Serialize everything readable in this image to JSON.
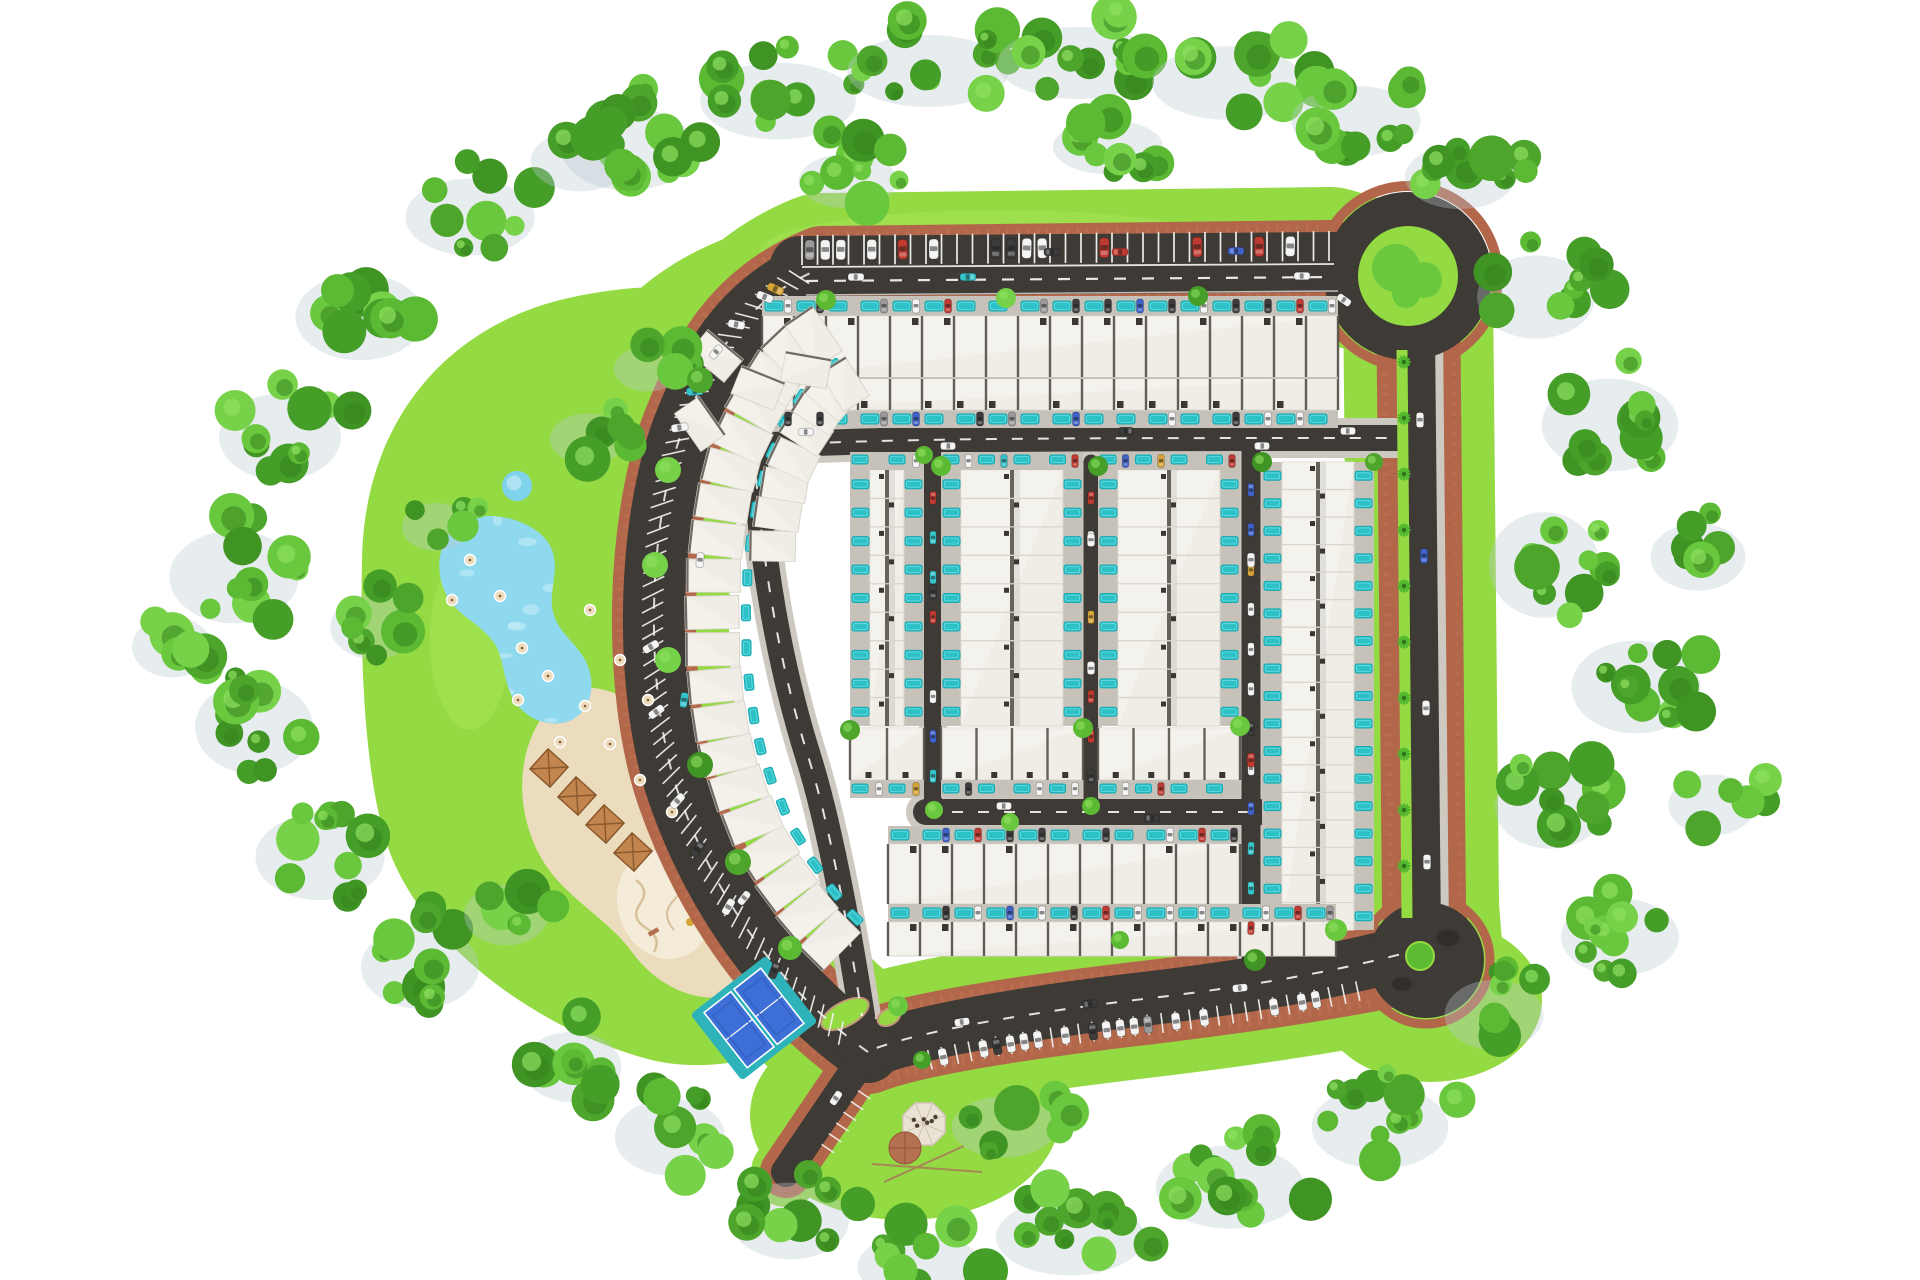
{
  "title": "Residential community master plan - aerial site rendering",
  "canvas": {
    "w": 1920,
    "h": 1280,
    "bg": "#ffffff"
  },
  "approx_counts": {
    "townhouse_units": 300,
    "parking_stalls": 190,
    "cars_visible": 150,
    "roundabouts": 2,
    "sport_courts": 2,
    "lakes": 1,
    "ponds": 1,
    "playgrounds": 1,
    "pergolas": 4,
    "pavilions": 1
  },
  "palette": {
    "lawn": "#94da43",
    "lawnLight": "#a9e55c",
    "asphalt": "#3e3a35",
    "asphaltLight": "#49443e",
    "brick": "#b2674a",
    "brickLight": "#c17a57",
    "brickDark": "#95533a",
    "sidewalk": "#cdc9c1",
    "houseFill": "#f0ede6",
    "houseEdge": "#d9d5cd",
    "houseHi": "#f7f5f0",
    "wallDark": "#4e4943",
    "plotGray": "#c6c2ba",
    "pool": "#2bc1c7",
    "poolDeep": "#17a9b0",
    "poolGlint": "#7fe0e4",
    "lake": "#8fd9ee",
    "lakeLight": "#c9edf8",
    "pond": "#7fd2ec",
    "sand": "#ecdcbe",
    "sandLight": "#f4ebd8",
    "sandLine": "#d6c19b",
    "courtBlue": "#3e6fd6",
    "courtBlueDark": "#2f5cbe",
    "courtApron": "#2fb3ba",
    "pergola": "#c2854d",
    "pergolaDark": "#8a5a2e",
    "pavilionRoof": "#eae2d4",
    "pavilionEdge": "#cfc3ad",
    "dome": "#b5714f",
    "domeDark": "#8f5438",
    "timber": "#a78757",
    "marking": "#f6f6f4",
    "shadow": "#b9c9d2",
    "islandCurb": "#c49a7a",
    "treeGreens": [
      "#4ea52c",
      "#5cb934",
      "#6ac83e",
      "#3f9423",
      "#77d24a",
      "#459e28"
    ],
    "treeDark": "#35821d",
    "treeLight": "#8fdf60",
    "palm": "#4fb52e",
    "palmDark": "#2e6e1a",
    "carColors": {
      "white": "#f2f3f2",
      "red": "#bf3a30",
      "blue": "#3f62c8",
      "teal": "#35c2c8",
      "yellow": "#d7a437",
      "dark": "#3c3c3c",
      "gray": "#9a9a9a"
    }
  },
  "seed": 11,
  "loop": {
    "main": "M 868 1052 C 778 988 714 896 678 792 C 643 690 646 514 688 416 C 714 352 748 298 822 268 L 1330 262 L 1418 288 L 1424 906 L 1428 958 C 1382 968 1302 984 1152 1002 C 1048 1014 918 1032 868 1052 Z",
    "lawnW": 150,
    "brickW": 84
  },
  "lawnShapes": {
    "park": "M 362 560 C 364 426 442 330 560 300 C 636 282 706 282 744 304 C 702 362 664 424 656 520 C 648 620 668 740 706 830 C 744 916 792 976 840 1022 C 786 1058 706 1076 644 1058 C 544 1030 432 954 392 858 C 364 788 360 660 362 560 Z",
    "topBand": "M 600 332 C 660 250 760 212 900 206 L 1340 202 C 1418 206 1466 234 1476 282 C 1482 318 1458 348 1420 356 L 1380 360 C 1300 330 1200 326 1000 326 L 700 330 Z",
    "pavilionLawn": {
      "cx": 905,
      "cy": 1115,
      "rx": 155,
      "ry": 105
    },
    "southEastLawn": {
      "cx": 1430,
      "cy": 1000,
      "rx": 112,
      "ry": 82
    }
  },
  "segments": {
    "top": {
      "d": "M 800 266 L 1340 262",
      "asphaltW": 60,
      "dashD": "M 806 281 L 1338 277",
      "sepD": "M 802 267 L 1334 264",
      "edgeD": "M 806 295 L 1338 291"
    },
    "right": {
      "d": "M 1420 332 L 1426 936",
      "asphaltW": 30,
      "sidewalkW": 46,
      "brickW": 64,
      "medianD": "M 1402 350 L 1407 918",
      "medianW": 11
    },
    "arc": {
      "d": "M 868 1052 C 778 988 714 896 678 792 C 643 690 646 514 688 416 C 714 352 748 298 822 268",
      "asphaltW": 62
    },
    "bottom": {
      "d": "M 1424 948 C 1380 960 1302 980 1152 998 C 1048 1010 918 1030 866 1052",
      "asphaltW": 54
    },
    "entrance": {
      "d": "M 870 1048 L 786 1172",
      "asphaltW": 30,
      "brickW": 52,
      "lawnW": 70
    }
  },
  "inner": [
    {
      "name": "road-a",
      "d": "M 752 446 C 900 438 1040 438 1398 438",
      "w": 26,
      "sw": 40,
      "dash": true
    },
    {
      "name": "inner-arc-road",
      "d": "M 754 452 C 762 560 778 660 808 756 C 830 826 848 926 862 1016",
      "w": 26,
      "sw": 38,
      "dash": true
    },
    {
      "name": "lane-b",
      "d": "M 933 450 L 933 802",
      "w": 18,
      "sw": 28,
      "dash": false
    },
    {
      "name": "lane-1",
      "d": "M 1091 462 L 1091 800",
      "w": 15,
      "sw": 22,
      "dash": false
    },
    {
      "name": "lane-d",
      "d": "M 1251 450 L 1251 956",
      "w": 19,
      "sw": 28,
      "dash": false
    },
    {
      "name": "road-c",
      "d": "M 926 812 L 1260 812",
      "w": 26,
      "sw": 40,
      "dash": true
    }
  ],
  "junctionPatch": {
    "cx": 866,
    "cy": 1046,
    "r": 27
  },
  "islands": [
    [
      845,
      1014,
      26,
      12,
      -28
    ],
    [
      889,
      1017,
      12,
      8,
      -28
    ]
  ],
  "roundabouts": {
    "north": {
      "cx": 1408,
      "cy": 276,
      "rAsphalt": 84,
      "rGreen": 50,
      "rBrick": 90,
      "trees": [
        [
          -12,
          -8,
          24
        ],
        [
          16,
          4,
          18
        ],
        [
          -2,
          18,
          14
        ]
      ]
    },
    "south": {
      "cx": 1426,
      "cy": 960,
      "rAsphalt": 58,
      "rGreen": 15,
      "greenOff": [
        -6,
        -4
      ],
      "rBrick": 64,
      "tree": [
        -6,
        -4,
        13
      ],
      "shadows": [
        [
          22,
          -22,
          12
        ],
        [
          -24,
          24,
          10
        ]
      ]
    }
  },
  "parking": {
    "top": {
      "x0": 802,
      "x1": 1334,
      "step": 15.5,
      "depth": 31,
      "occ": 0.5
    },
    "arc": {
      "offset": 12,
      "len": 24,
      "step": 13,
      "skewDeg": 62,
      "occ": 0.15,
      "t0": 0.03,
      "t1": 0.97
    },
    "bottom": {
      "offset": 16,
      "len": 20,
      "step": 14,
      "occ": 0.5,
      "t0": 0.13,
      "t1": 0.9
    },
    "entrance": {
      "offset": 14,
      "len": 15,
      "step": 13,
      "t0": 0.28,
      "count": 6
    }
  },
  "blocks": {
    "topRows": {
      "x0": 762,
      "lots": 18,
      "lotW": 32,
      "padTop": {
        "y": 296,
        "h": 20
      },
      "padBot": {
        "y": 410,
        "h": 18
      },
      "rows": [
        {
          "y": 316,
          "h": 62
        },
        {
          "y": 378,
          "h": 32
        }
      ]
    },
    "slabs": [
      {
        "x": 850,
        "w": 74,
        "yTop": 470,
        "yBot": 726,
        "units": 9,
        "headerPad": true,
        "transverse": true
      },
      {
        "x": 941,
        "w": 142,
        "yTop": 470,
        "yBot": 726,
        "units": 9,
        "headerPad": true,
        "transverse": true
      },
      {
        "x": 1098,
        "w": 142,
        "yTop": 470,
        "yBot": 726,
        "units": 9,
        "headerPad": true,
        "transverse": true
      },
      {
        "x": 1262,
        "w": 112,
        "yTop": 462,
        "yBot": 930,
        "units": 17,
        "headerPad": false,
        "transverse": false
      }
    ],
    "transverseH": 52,
    "transPadH": 18,
    "lanesCars": [
      {
        "x": 933,
        "y0": 478,
        "y1": 796,
        "n": 8
      },
      {
        "x": 1091,
        "y0": 478,
        "y1": 796,
        "n": 8
      },
      {
        "x": 1251,
        "y0": 470,
        "y1": 948,
        "n": 12
      }
    ],
    "bottomRows": [
      {
        "x0": 888,
        "lots": 11,
        "lotW": 32,
        "padY": 826,
        "houseY": 844,
        "houseH": 60
      },
      {
        "x0": 888,
        "lots": 14,
        "lotW": 32,
        "padY": 904,
        "houseY": 922,
        "houseH": 34
      }
    ],
    "arcCluster": {
      "useArcPath": true,
      "inset": 58,
      "step": 40,
      "t0": 0.12,
      "t1": 0.97,
      "w": 33,
      "d": 54,
      "row2": {
        "tMin": 0.62,
        "extraInset": 56,
        "w": 30,
        "d": 46
      }
    },
    "extraHouses": [
      [
        716,
        356,
        40
      ],
      [
        758,
        388,
        22
      ],
      [
        700,
        424,
        55
      ],
      [
        806,
        370,
        10
      ]
    ]
  },
  "amenities": {
    "lake": "M 468 520 C 440 532 432 566 446 594 C 456 615 478 622 492 640 C 505 656 502 680 514 700 C 527 722 556 730 575 718 C 594 706 596 678 584 658 C 573 640 558 632 553 612 C 548 590 560 572 552 550 C 543 524 496 508 468 520 Z",
    "pond": {
      "cx": 517,
      "cy": 486,
      "r": 15
    },
    "beach": "M 556 700 C 518 738 512 800 538 852 C 560 896 606 916 632 952 C 658 988 700 1006 738 994 C 772 983 780 948 764 912 C 746 872 712 860 696 818 C 680 776 676 736 646 712 C 616 688 580 678 556 700 Z",
    "playground": {
      "cx": 664,
      "cy": 905,
      "rx": 46,
      "ry": 55,
      "rot": -20
    },
    "pergolas": [
      [
        549,
        768
      ],
      [
        577,
        796
      ],
      [
        605,
        824
      ],
      [
        633,
        852
      ]
    ],
    "pergolaSize": 27,
    "pergolaRot": 42,
    "umbrellas": [
      [
        470,
        560
      ],
      [
        452,
        600
      ],
      [
        500,
        596
      ],
      [
        522,
        648
      ],
      [
        548,
        676
      ],
      [
        585,
        706
      ],
      [
        610,
        744
      ],
      [
        648,
        700
      ],
      [
        620,
        660
      ],
      [
        590,
        610
      ],
      [
        640,
        780
      ],
      [
        672,
        812
      ],
      [
        518,
        700
      ],
      [
        560,
        742
      ]
    ],
    "courts": {
      "cx": 754,
      "cy": 1018,
      "rot": -38,
      "apronW": 96,
      "apronH": 84,
      "courtW": 34,
      "courtH": 70,
      "gap": 38
    },
    "pavilion": {
      "cx": 924,
      "cy": 1124,
      "r": 23,
      "domeCx": 905,
      "domeCy": 1148,
      "domeR": 16
    }
  },
  "trees": {
    "clusters": [
      [
        640,
        140,
        70,
        52,
        11
      ],
      [
        790,
        92,
        82,
        48,
        12
      ],
      [
        940,
        62,
        85,
        45,
        12
      ],
      [
        1090,
        54,
        85,
        45,
        12
      ],
      [
        1240,
        74,
        80,
        46,
        12
      ],
      [
        1368,
        112,
        68,
        44,
        11
      ],
      [
        1472,
        168,
        58,
        40,
        9
      ],
      [
        860,
        172,
        52,
        34,
        8
      ],
      [
        1120,
        138,
        58,
        34,
        8
      ],
      [
        1548,
        288,
        62,
        52,
        10
      ],
      [
        1622,
        416,
        72,
        58,
        11
      ],
      [
        1556,
        556,
        58,
        66,
        10
      ],
      [
        1648,
        678,
        68,
        58,
        11
      ],
      [
        1562,
        798,
        58,
        52,
        9
      ],
      [
        1632,
        928,
        62,
        48,
        10
      ],
      [
        1506,
        1006,
        52,
        44,
        8
      ],
      [
        1710,
        548,
        50,
        42,
        7
      ],
      [
        1724,
        796,
        46,
        38,
        6
      ],
      [
        1392,
        1118,
        72,
        52,
        11
      ],
      [
        1242,
        1178,
        78,
        52,
        12
      ],
      [
        1082,
        1228,
        78,
        48,
        11
      ],
      [
        932,
        1258,
        66,
        42,
        9
      ],
      [
        802,
        1212,
        62,
        48,
        9
      ],
      [
        682,
        1128,
        58,
        48,
        9
      ],
      [
        584,
        1058,
        52,
        44,
        8
      ],
      [
        1016,
        1118,
        55,
        38,
        7
      ],
      [
        432,
        958,
        62,
        52,
        10
      ],
      [
        332,
        848,
        68,
        54,
        10
      ],
      [
        266,
        718,
        62,
        58,
        10
      ],
      [
        246,
        568,
        68,
        58,
        11
      ],
      [
        292,
        428,
        64,
        54,
        10
      ],
      [
        372,
        308,
        68,
        54,
        10
      ],
      [
        482,
        208,
        68,
        48,
        10
      ],
      [
        592,
        152,
        52,
        38,
        7
      ],
      [
        184,
        638,
        42,
        38,
        6
      ],
      [
        448,
        518,
        36,
        30,
        5
      ],
      [
        386,
        618,
        46,
        40,
        7
      ],
      [
        518,
        906,
        44,
        38,
        6
      ],
      [
        600,
        430,
        40,
        32,
        6
      ],
      [
        660,
        360,
        36,
        28,
        5
      ]
    ],
    "singles": [
      [
        700,
        380,
        13
      ],
      [
        668,
        470,
        13
      ],
      [
        655,
        565,
        13
      ],
      [
        668,
        660,
        13
      ],
      [
        700,
        765,
        13
      ],
      [
        738,
        862,
        13
      ],
      [
        790,
        948,
        12
      ],
      [
        826,
        300,
        10
      ],
      [
        1006,
        298,
        10
      ],
      [
        1198,
        296,
        10
      ],
      [
        941,
        466,
        10
      ],
      [
        1083,
        728,
        10
      ],
      [
        1098,
        466,
        10
      ],
      [
        1240,
        726,
        10
      ],
      [
        1262,
        462,
        10
      ],
      [
        934,
        810,
        9
      ],
      [
        1255,
        960,
        11
      ],
      [
        1091,
        806,
        9
      ],
      [
        850,
        730,
        10
      ],
      [
        924,
        455,
        9
      ],
      [
        1336,
        930,
        11
      ],
      [
        1374,
        462,
        9
      ],
      [
        1010,
        822,
        9
      ],
      [
        1120,
        940,
        9
      ],
      [
        898,
        1006,
        10
      ],
      [
        922,
        1060,
        9
      ]
    ],
    "median": {
      "x": 1404,
      "y0": 362,
      "y1": 916,
      "step": 56
    }
  },
  "roadCars": [
    [
      856,
      277,
      0,
      "white",
      16
    ],
    [
      968,
      277,
      0,
      "teal",
      16
    ],
    [
      1120,
      252,
      180,
      "red",
      16
    ],
    [
      1236,
      251,
      180,
      "blue",
      16
    ],
    [
      1302,
      276,
      0,
      "white",
      16
    ],
    [
      1052,
      252,
      180,
      "dark",
      16
    ],
    [
      806,
      432,
      0,
      "white",
      15
    ],
    [
      948,
      446,
      180,
      "white",
      15
    ],
    [
      1126,
      431,
      0,
      "dark",
      15
    ],
    [
      1262,
      446,
      180,
      "white",
      15
    ],
    [
      1348,
      431,
      0,
      "white",
      15
    ],
    [
      1004,
      806,
      0,
      "white",
      15
    ],
    [
      1152,
      818,
      180,
      "dark",
      15
    ],
    [
      933,
      592,
      90,
      "dark",
      14
    ],
    [
      1091,
      540,
      90,
      "white",
      13
    ],
    [
      1091,
      668,
      270,
      "white",
      13
    ],
    [
      1251,
      560,
      90,
      "white",
      14
    ],
    [
      1251,
      760,
      270,
      "red",
      14
    ],
    [
      1420,
      420,
      90,
      "white",
      15
    ],
    [
      1424,
      556,
      90,
      "blue",
      15
    ],
    [
      1426,
      708,
      270,
      "white",
      15
    ],
    [
      1427,
      862,
      90,
      "white",
      15
    ],
    [
      1240,
      988,
      -6,
      "white",
      15
    ],
    [
      1090,
      1004,
      174,
      "dark",
      15
    ],
    [
      962,
      1022,
      -8,
      "white",
      15
    ],
    [
      700,
      560,
      94,
      "white",
      15
    ],
    [
      684,
      700,
      98,
      "teal",
      15
    ],
    [
      744,
      898,
      128,
      "white",
      15
    ],
    [
      716,
      352,
      130,
      "white",
      15
    ],
    [
      836,
      1098,
      -56,
      "white",
      15
    ],
    [
      1344,
      300,
      35,
      "white",
      15
    ]
  ],
  "carWeights": {
    "stall": [
      [
        "white",
        5
      ],
      [
        "dark",
        1.5
      ],
      [
        "red",
        1.2
      ],
      [
        "blue",
        0.8
      ],
      [
        "teal",
        0.8
      ],
      [
        "yellow",
        0.7
      ],
      [
        "gray",
        0.9
      ]
    ],
    "alley": [
      [
        "white",
        2
      ],
      [
        "dark",
        1
      ],
      [
        "red",
        2
      ],
      [
        "blue",
        1.5
      ],
      [
        "teal",
        2
      ],
      [
        "yellow",
        1.5
      ]
    ],
    "driveway": [
      [
        "dark",
        3
      ],
      [
        "white",
        3
      ],
      [
        "gray",
        1.5
      ],
      [
        "red",
        1
      ],
      [
        "blue",
        0.8
      ]
    ]
  }
}
